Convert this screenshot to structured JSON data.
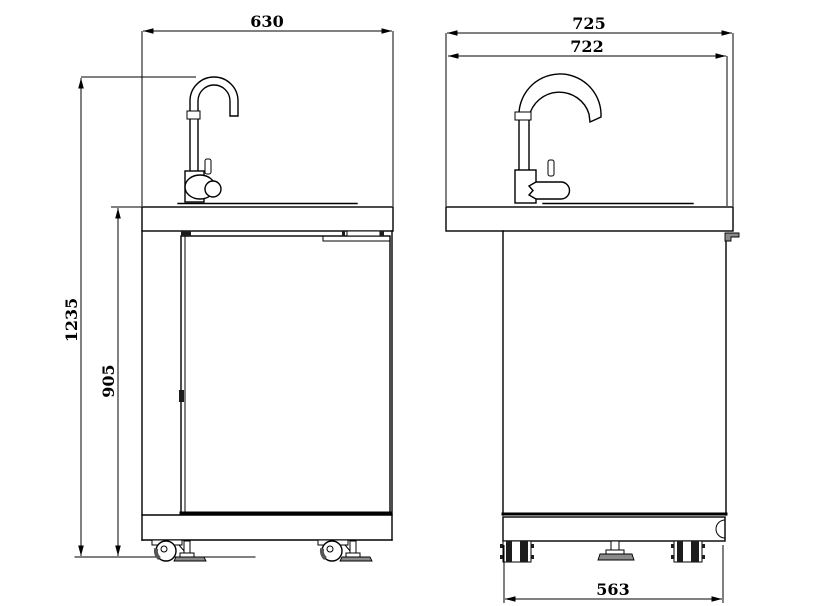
{
  "drawing": {
    "type": "technical-dimension-drawing",
    "colors": {
      "line": "#000000",
      "shade": "#8a8a8a",
      "background": "#ffffff"
    },
    "views": {
      "front": {
        "dimensions": {
          "width": "630",
          "overall_height": "1235",
          "worktop_height": "905"
        }
      },
      "side": {
        "dimensions": {
          "overall_depth": "725",
          "worktop_depth": "722",
          "base_depth": "563"
        }
      }
    }
  }
}
